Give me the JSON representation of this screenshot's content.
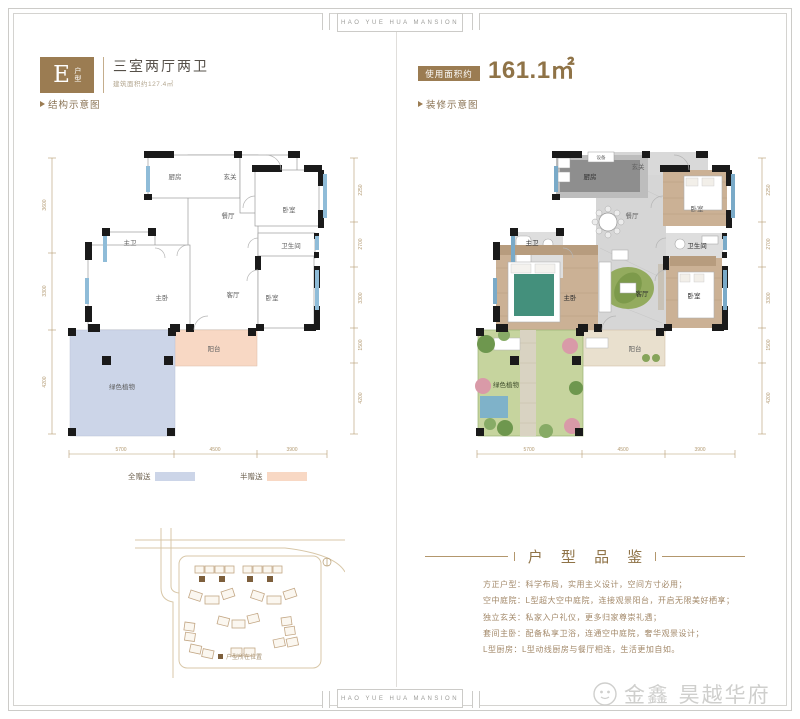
{
  "frame": {
    "banner": "HAO YUE HUA MANSION"
  },
  "left_panel": {
    "badge_letter": "E",
    "badge_type": "户型",
    "title": "三室两厅两卫",
    "subtitle": "建筑面积约127.4㎡",
    "section_label": "结构示意图",
    "rooms": {
      "kitchen": "厨房",
      "foyer": "玄关",
      "bedroom_top": "卧室",
      "dining": "餐厅",
      "bath": "卫生间",
      "master_bath": "主卫",
      "master_bedroom": "主卧",
      "living": "客厅",
      "bedroom_bottom": "卧室",
      "balcony": "阳台",
      "plants": "绿色植物"
    },
    "dims_h": [
      "5700",
      "4500",
      "3900"
    ],
    "dims_v_right": [
      "2250",
      "2700",
      "3300",
      "1500",
      "4200"
    ],
    "dims_v_left": [
      "3600",
      "3300",
      "4200"
    ],
    "legend": {
      "full": "全赠送",
      "half": "半赠送"
    },
    "sitemap_note": "户型所在位置"
  },
  "right_panel": {
    "area_label": "使用面积约",
    "area_value": "161.1㎡",
    "section_label": "装修示意图",
    "rooms": {
      "equipment": "设备",
      "kitchen": "厨房",
      "foyer": "玄关",
      "bedroom_top": "卧室",
      "dining": "餐厅",
      "bath": "卫生间",
      "master_bath": "主卫",
      "master_bedroom": "主卧",
      "living": "客厅",
      "bedroom_bottom": "卧室",
      "balcony": "阳台",
      "plants": "绿色植物"
    },
    "dims_h": [
      "5700",
      "4500",
      "3900"
    ],
    "dims_v_right": [
      "2250",
      "2700",
      "3300",
      "1500",
      "4200"
    ],
    "dims_v_left": [
      "3600",
      "3300",
      "4200"
    ]
  },
  "review": {
    "title": "户 型 品 鉴",
    "lines": [
      "方正户型：科学布局，实用主义设计，空间方寸必用；",
      "空中庭院：L型超大空中庭院，连接观景阳台，开启无限美好栖享；",
      "独立玄关：私家入户礼仪，更多归家尊崇礼遇；",
      "套间主卧：配备私享卫浴，连通空中庭院，奢华观景设计；",
      "L型厨房：L型动线厨房与餐厅相连，生活更加自如。"
    ]
  },
  "logo": {
    "text": "金鑫 昊越华府"
  },
  "colors": {
    "accent_brown": "#9b7c52",
    "full_gift_blue": "#ccd5e8",
    "half_gift_peach": "#f8d8c4",
    "window_blue": "#8fbcd8",
    "wood": "#cbb195",
    "garden_green": "#c6d49e"
  }
}
